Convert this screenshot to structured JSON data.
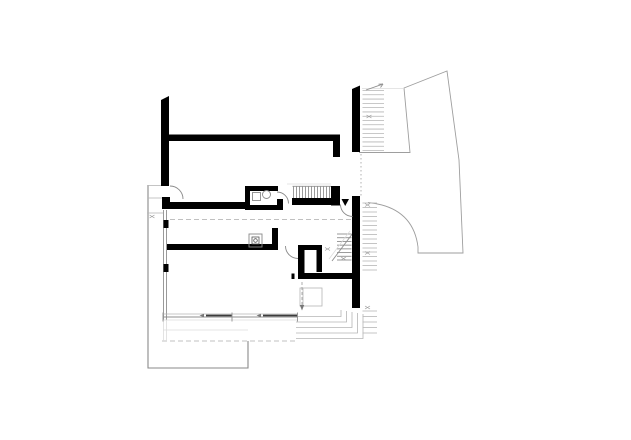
{
  "document": {
    "kind": "architectural floor plan (basement level line drawing)",
    "visible_text": "none",
    "sheet": {
      "width_px": 631,
      "height_px": 440,
      "background": "#ffffff"
    }
  },
  "colors": {
    "wall": "#000000",
    "line-light": "#b5b5b5",
    "line-mid": "#8f8f8f",
    "line-faint": "#dcdcdc",
    "line-dark": "#3c3c3c",
    "dash": "#c0c0c0",
    "bg": "#ffffff"
  },
  "plan": {
    "elements": [
      "thick black exterior and interior walls",
      "upper interior stair flight with vertical treads",
      "lower interior stair flight with diagonal break line",
      "entrance opening with black triangle direction marker",
      "bathroom with washbasin circle and square fixture",
      "kitchen fixture box with small circle",
      "inner closet room",
      "fireplace square with dashed flue arrow",
      "exterior stair runs hatched along right wall",
      "curved garden path and terrain outline at upper right",
      "terrace outline and nested corner steps at bottom",
      "window glazing lines along bottom wall",
      "dashed section lines",
      "small x level markers"
    ]
  }
}
